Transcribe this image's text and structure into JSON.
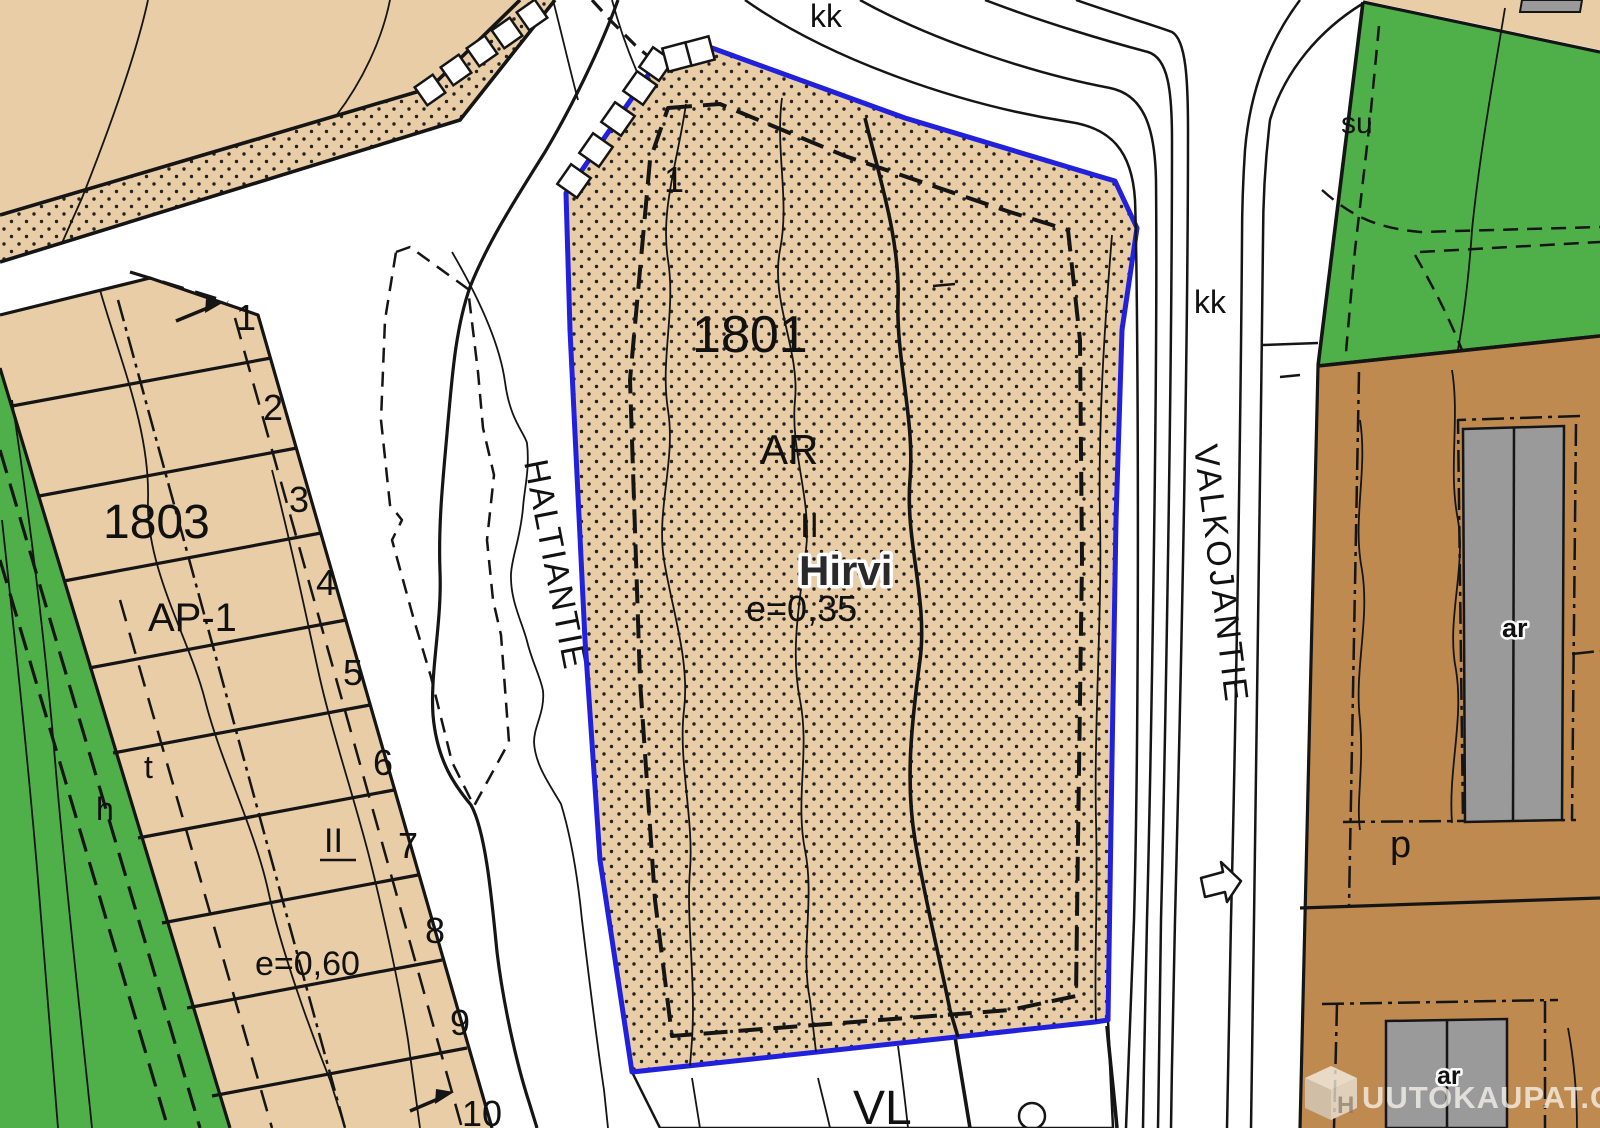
{
  "map": {
    "roads": {
      "haltiantie": "HALTIANTIE",
      "valkojantie": "VALKOJANTIE",
      "kk_top": "kk",
      "kk_right": "kk"
    },
    "parcel_1801": {
      "block_number": "1801",
      "lot_number": "1",
      "land_use": "AR",
      "storeys": "II",
      "name": "Hirvi",
      "efficiency": "e=0,35"
    },
    "parcel_1803": {
      "block_number": "1803",
      "land_use": "AP-1",
      "storeys": "II",
      "efficiency": "e=0,60",
      "letter_t": "t",
      "letter_h": "h",
      "lot_numbers": [
        "1",
        "2",
        "3",
        "4",
        "5",
        "6",
        "7",
        "8",
        "9",
        "10"
      ]
    },
    "areas": {
      "vl": "VL",
      "su": "su",
      "p": "p",
      "ar_north": "ar",
      "ar_south": "ar"
    },
    "watermark": {
      "logo_letter": "H",
      "text": "UUTOKAUPAT.COM"
    },
    "colors": {
      "parcel_tan": "#e8cda6",
      "green_dark": "#4fb04a",
      "green_light": "#7cc47e",
      "brown": "#bf8a50",
      "building_gray": "#9a9a9a",
      "boundary_blue": "#2121dd",
      "line_black": "#151515"
    }
  }
}
